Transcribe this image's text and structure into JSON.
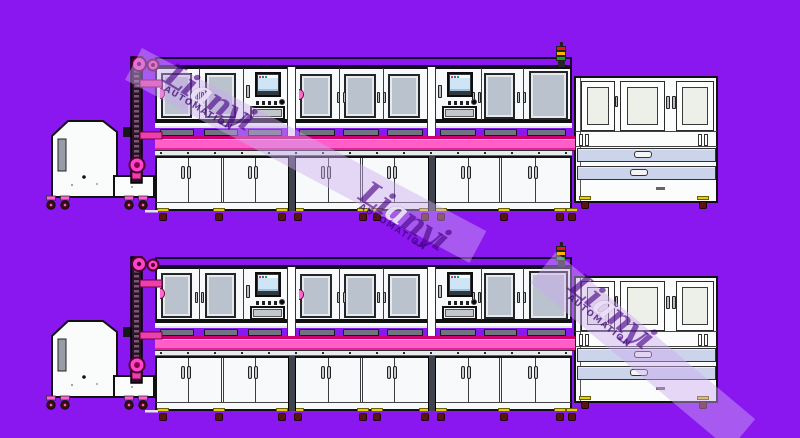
{
  "watermark": {
    "brand_lead": "Li",
    "brand_highlight": "a",
    "brand_tail": "nyi",
    "subtitle": "AUTOMATION"
  },
  "palette": {
    "background": "#8a17f0",
    "cabinet_white": "#f8f9fa",
    "window_gray": "#b9c2cd",
    "conveyor_pink": "#ff5ec8",
    "conveyor_edge": "#cf0070",
    "accent_magenta": "#ee3fae",
    "drawer_lavender": "#ccd4ec",
    "tower_red": "#e31515",
    "tower_amber": "#ffb400",
    "tower_green": "#16a321",
    "watermark_purple": "rgba(70,0,132,0.62)"
  },
  "scene": {
    "rows": 2
  }
}
